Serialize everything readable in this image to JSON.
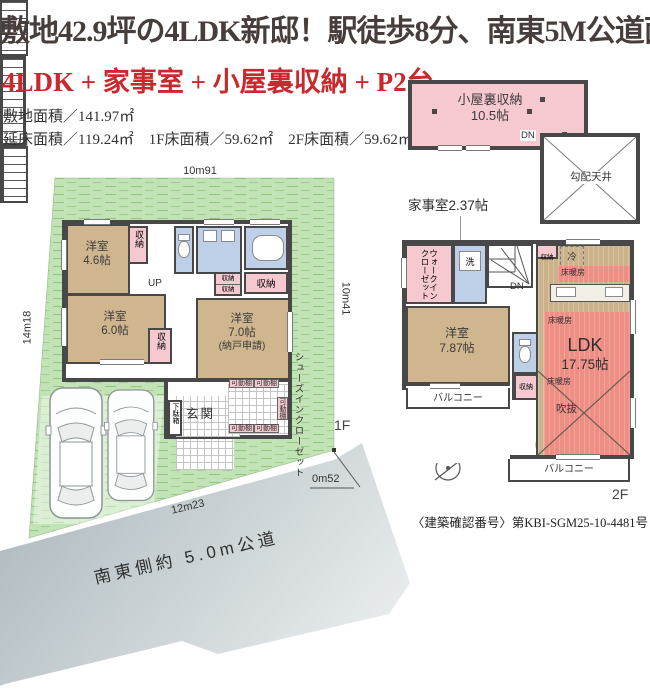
{
  "header": {
    "title": "敷地42.9坪の4LDK新邸！駅徒歩8分、南東5M公道面！",
    "subtitle": "4LDK + 家事室 + 小屋裏収納 + P2台",
    "site_area": "敷地面積／141.97㎡",
    "floor_areas": "延床面積／119.24㎡　1F床面積／59.62㎡　2F床面積／59.62㎡"
  },
  "labels": {
    "storage": "収納",
    "shelf": "可動棚",
    "floor_heating": "床暖房",
    "balcony": "バルコニー",
    "up": "UP",
    "dn": "DN"
  },
  "floor1": {
    "floor_tag": "1F",
    "dims": {
      "top": "10m91",
      "left": "14m18",
      "right": "10m41",
      "bottom": "12m23",
      "corner": "0m52"
    },
    "road_label": "南東側約 5.0m公道",
    "rooms": {
      "bedroom46": {
        "name": "洋室",
        "size": "4.6帖"
      },
      "bedroom60": {
        "name": "洋室",
        "size": "6.0帖"
      },
      "bedroom70": {
        "name": "洋室",
        "size": "7.0帖",
        "note": "(納戸申請)"
      },
      "entrance": "玄関",
      "shoe_cabinet": "下駄箱",
      "shoes_closet": "シューズインクローゼット"
    }
  },
  "floor2": {
    "floor_tag": "2F",
    "rooms": {
      "wic_line1": "ウォークイン",
      "wic_line2": "クローゼット",
      "laundry": "洗",
      "bedroom787": {
        "name": "洋室",
        "size": "7.87帖"
      },
      "ldk": {
        "name": "LDK",
        "size": "17.75帖"
      },
      "fridge": "冷",
      "void": "吹抜"
    }
  },
  "attic": {
    "storage_name": "小屋裏収納",
    "storage_size": "10.5帖",
    "sloped_ceiling": "勾配天井",
    "utility_room": "家事室2.37帖"
  },
  "note": "〈建築確認番号〉第KBI-SGM25-10-4481号",
  "colors": {
    "accent_red": "#c9282d",
    "wall": "#484848",
    "wood_tan": "#d0b68e",
    "storage_pink": "#f6c9d0",
    "water_blue": "#bdd0e7",
    "floor_heat_red": "#ee8e84",
    "lawn_green": "#c2e3b5",
    "road_gray": "#c3ccd0"
  }
}
